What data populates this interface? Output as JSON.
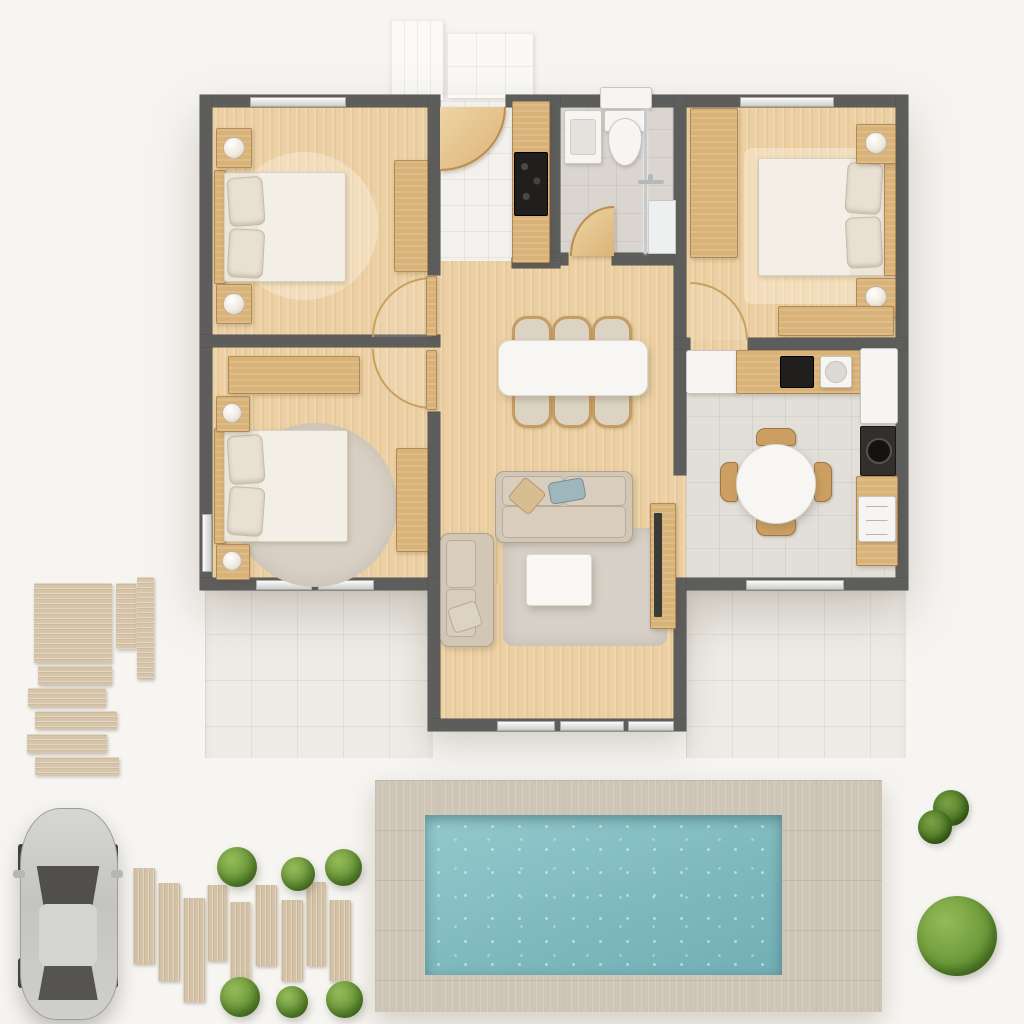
{
  "scene": {
    "description": "3D top-down architectural render of a small single-storey house floor plan with backyard pool, patio, planted path and a parked car",
    "visible_text": "none",
    "style": "photorealistic dollhouse / bird's-eye render on plain off-white ground"
  },
  "house": {
    "walls": "dark gray",
    "rooms": [
      {
        "id": "bedroom-top-left",
        "floor": "light wood",
        "items": [
          "double-bed",
          "two-pillows",
          "round-rug",
          "nightstand-with-lamp-top",
          "nightstand-with-lamp-bottom",
          "wardrobe",
          "window-top",
          "door-to-hall"
        ]
      },
      {
        "id": "bedroom-bottom-left",
        "floor": "light wood",
        "items": [
          "double-bed",
          "two-pillows",
          "large-round-gray-rug",
          "nightstand-with-lamp-top",
          "nightstand-with-lamp-bottom",
          "wardrobe-strip",
          "dresser",
          "two-windows-bottom",
          "door-to-hall"
        ]
      },
      {
        "id": "entry-hall",
        "floor": "white tile + wood",
        "items": [
          "front-door-swing",
          "kitchenette-counter",
          "black-cooktop"
        ]
      },
      {
        "id": "bathroom",
        "floor": "gray tile",
        "items": [
          "sink-basin",
          "toilet-with-cistern",
          "shower-with-glass",
          "shower-handle",
          "door-swing"
        ]
      },
      {
        "id": "bedroom-top-right",
        "floor": "light wood",
        "items": [
          "double-bed",
          "two-pillows",
          "area-rug",
          "tall-wardrobe",
          "nightstand-with-lamp-top",
          "nightstand-with-lamp-bottom",
          "dresser-bench",
          "window-top",
          "door-swing"
        ]
      },
      {
        "id": "dining-living-area",
        "floor": "light wood",
        "items": [
          "white-dining-table",
          "six-dining-chairs",
          "main-sofa",
          "loveseat",
          "throw-pillows",
          "gray-area-rug",
          "white-coffee-table",
          "tv-console",
          "glazed-bay-with-sliding-windows"
        ]
      },
      {
        "id": "kitchen",
        "floor": "light tile",
        "items": [
          "fridge-cabinet",
          "wood-counter",
          "black-cooktop",
          "sink",
          "tall-white-cabinet",
          "dark-oven-nook",
          "side-counter",
          "white-appliance",
          "round-dining-table",
          "four-chairs",
          "window-bottom"
        ]
      }
    ]
  },
  "outdoor": {
    "items": [
      "entry-paving-slabs",
      "left-patio-tiles",
      "right-patio-tiles",
      "wood-deck-panel",
      "five-deck-steps",
      "nine-plank-garden-path",
      "six-round-bushes",
      "two-spiky-plants",
      "large-bush",
      "swimming-pool",
      "pool-deck",
      "silver-car-top-view"
    ]
  },
  "counts": {
    "bedrooms": 3,
    "bathrooms": 1,
    "dining_chairs": 6,
    "kitchen_chairs": 4,
    "garden_planks": 9,
    "deck_steps": 5,
    "small_bushes": 6,
    "spiky_plants": 2,
    "large_bushes": 1,
    "cars": 1
  },
  "palette": {
    "background": "#f5f3f0",
    "wall": "#5d5d5b",
    "wood_floor": "#ecd0a3",
    "wood_furniture": "#d9b277",
    "tile_bath": "#dad5cf",
    "tile_kitchen": "#e2ded8",
    "tile_patio": "#efece7",
    "pool_water": "#85bfc4",
    "pool_deck": "#cec5b6",
    "greenery": "#6e9b3c",
    "fabric": "#d2c7b6",
    "bedding": "#f1ebe1",
    "fixture_white": "#f6f5f2",
    "car_body": "#c9c9c7",
    "car_glass": "#504f4b",
    "accent_pillow_blue": "#9db7bc"
  }
}
